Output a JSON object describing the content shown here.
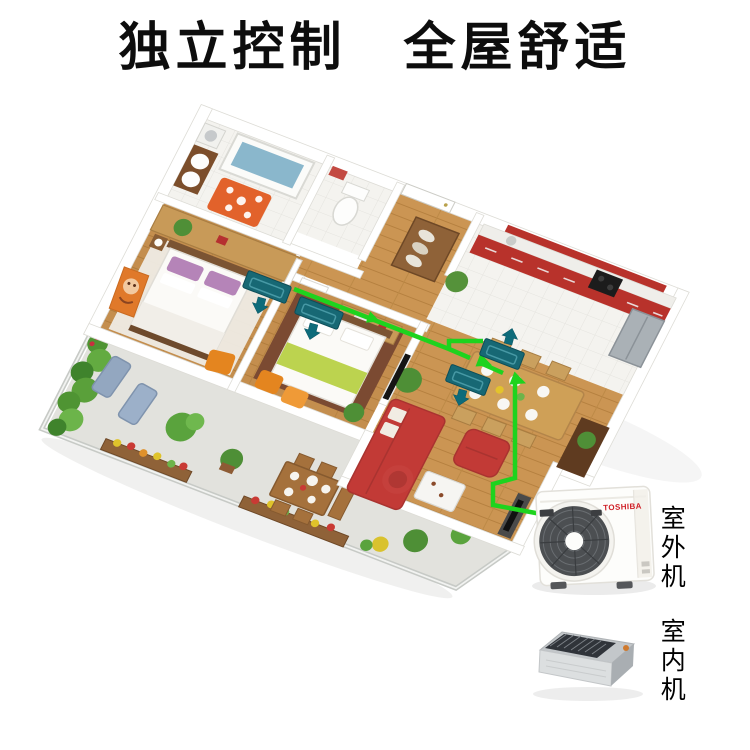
{
  "title": "独立控制　全屋舒适",
  "units": {
    "outdoor": {
      "label": "室外机",
      "brand": "TOSHIBA"
    },
    "indoor": {
      "label": "室内机"
    },
    "indoor_units_in_plan": 4
  },
  "colors": {
    "pipe_green": "#1ed31e",
    "unit_teal": "#176874",
    "arrow_teal": "#0d6b7a",
    "sofa_red": "#c23a36",
    "cabinet_red": "#b8322b",
    "floor_wood": "#cb9553",
    "terrace_gray": "#dcdcd6",
    "title_color": "#0d0d0d"
  }
}
